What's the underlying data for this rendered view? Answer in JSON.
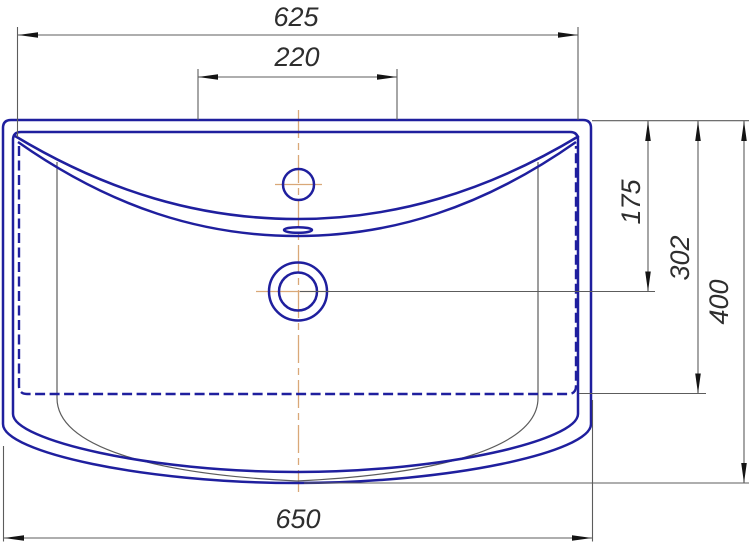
{
  "dimensions": {
    "top_width": "625",
    "faucet_zone_width": "220",
    "right_top": "175",
    "right_middle": "302",
    "right_bottom": "400",
    "bottom_width": "650"
  },
  "colors": {
    "background": "#ffffff",
    "outline_blue": "#1f1f9e",
    "centerline_orange": "#d9a878",
    "dimension_gray": "#5c5c5c",
    "arrow_black": "#141414",
    "label_text": "#2e2e2e"
  }
}
